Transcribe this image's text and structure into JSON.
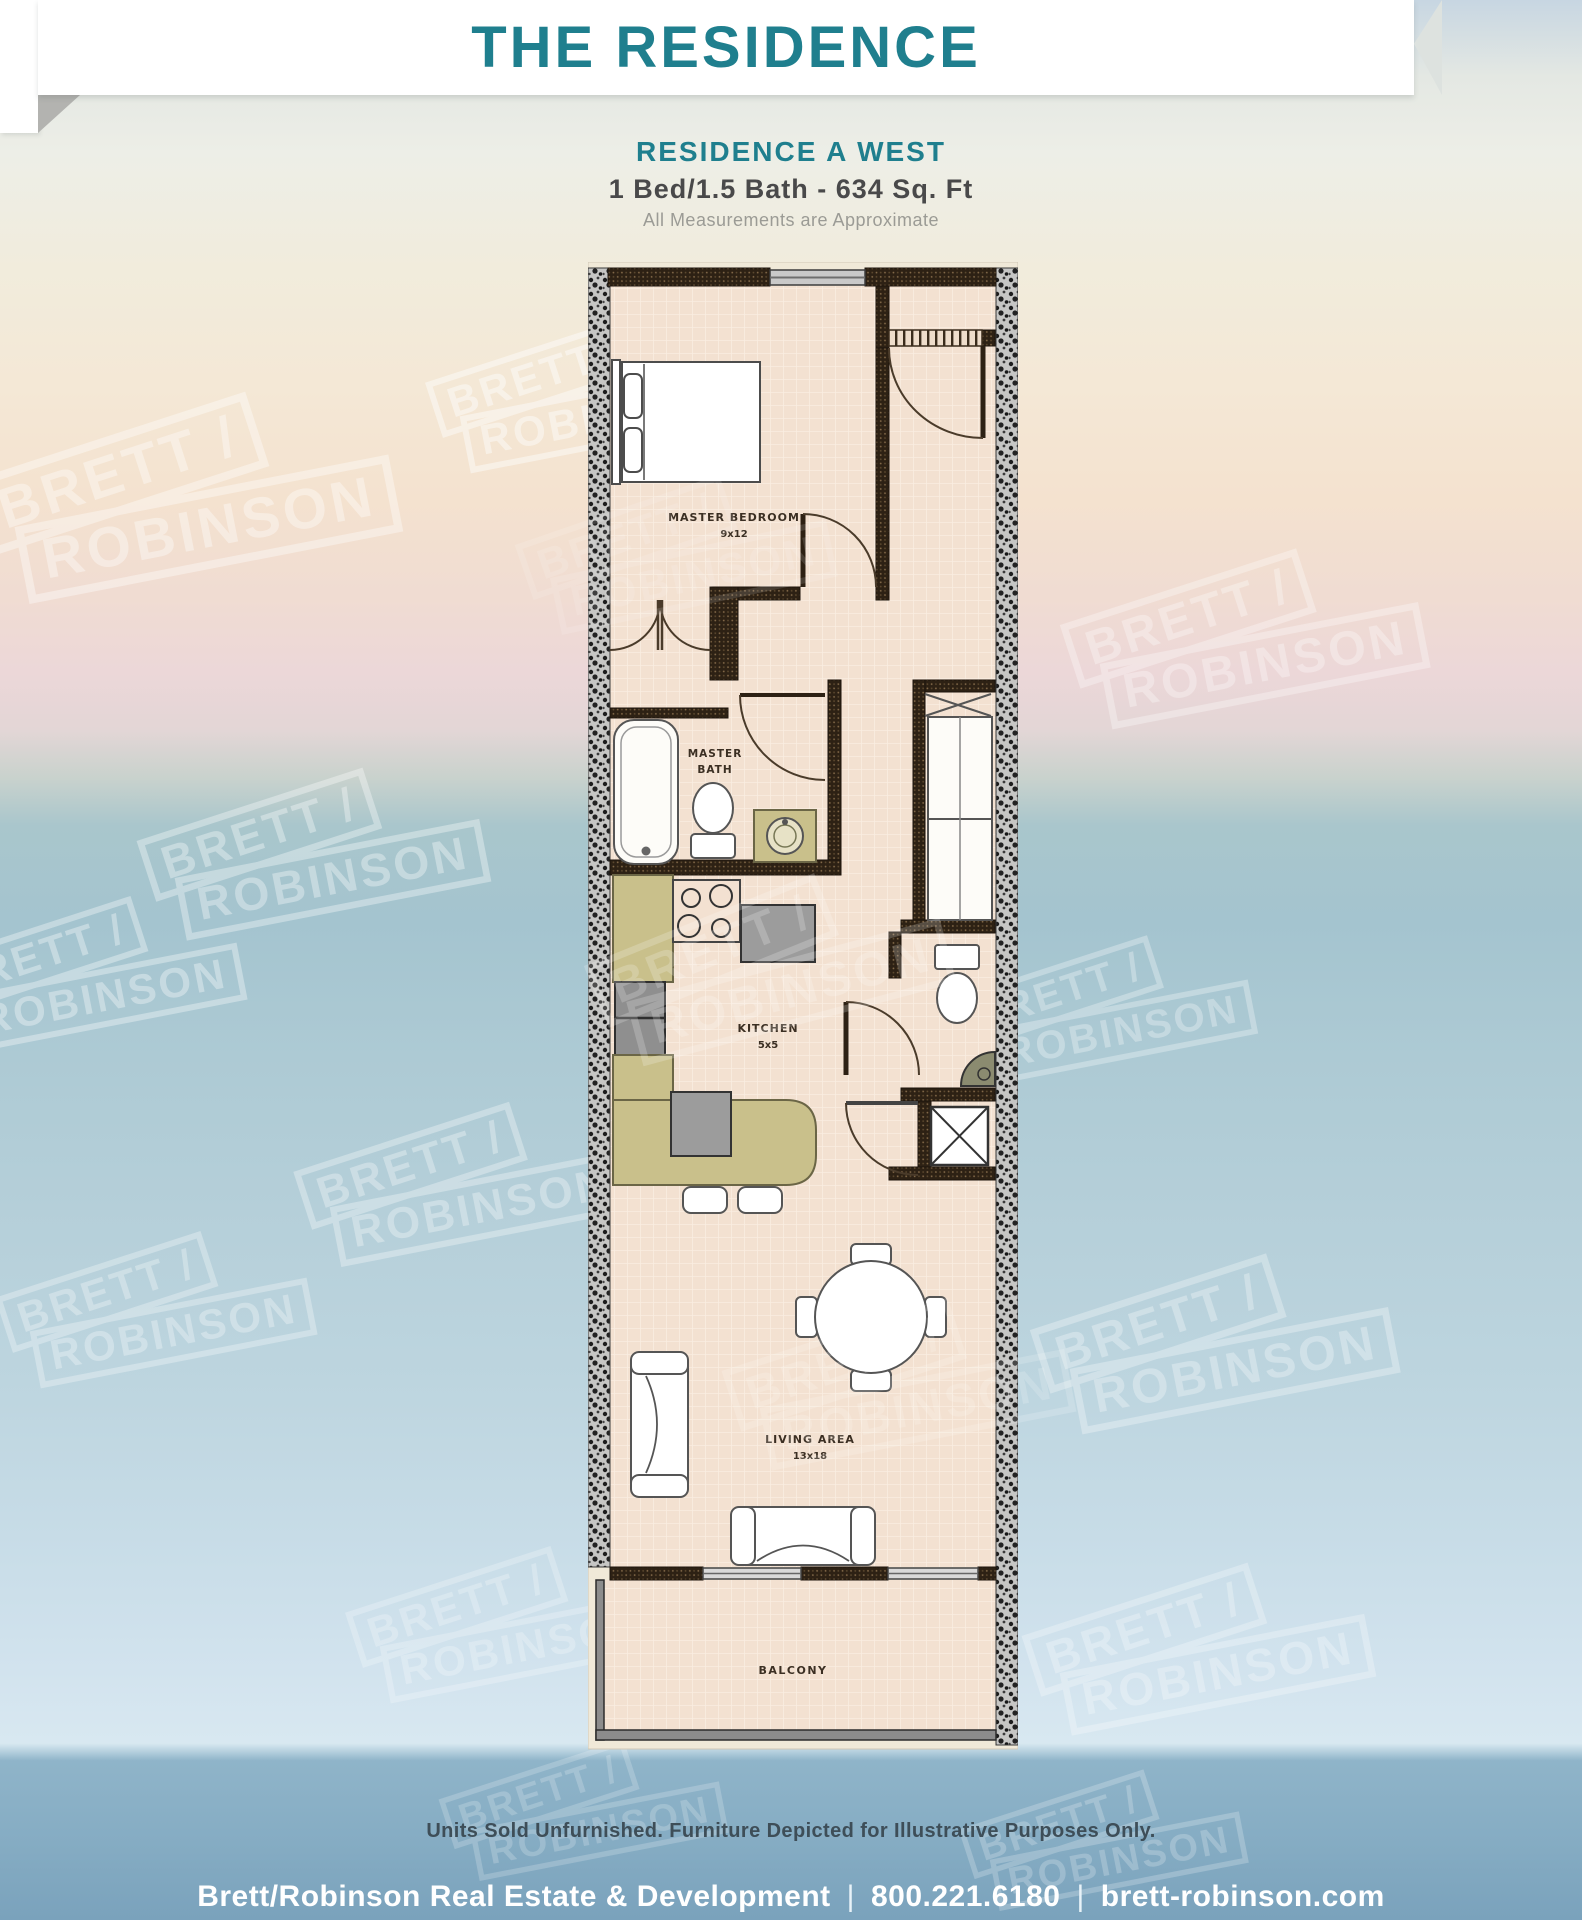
{
  "page": {
    "banner_title": "THE RESIDENCE",
    "heading": {
      "name": "RESIDENCE  A WEST",
      "specs": "1 Bed/1.5 Bath - 634 Sq. Ft",
      "note": "All Measurements are Approximate"
    },
    "rooms": {
      "master_bedroom": {
        "label": "MASTER BEDROOM",
        "dims": "9x12"
      },
      "master_bath": {
        "label_line1": "MASTER",
        "label_line2": "BATH"
      },
      "kitchen": {
        "label": "KITCHEN",
        "dims": "5x5"
      },
      "living_area": {
        "label": "LIVING AREA",
        "dims": "13x18"
      },
      "balcony": {
        "label": "BALCONY"
      }
    },
    "watermark": {
      "line1": "BRETT /",
      "line2": "ROBINSON"
    },
    "disclaimer": "Units Sold Unfurnished. Furniture Depicted for Illustrative Purposes Only.",
    "footer": {
      "company": "Brett/Robinson Real Estate & Development",
      "divider": "|",
      "phone": "800.221.6180",
      "website": "brett-robinson.com"
    }
  },
  "colors": {
    "accent_teal": "#1f7f8e",
    "wall_dark": "#2d2114",
    "floor_beige": "#f3e1d1",
    "counter_olive": "#c9c08b",
    "appliance_gray": "#9c9c9c",
    "ocean_footer_blue": "#8fb4c9"
  }
}
